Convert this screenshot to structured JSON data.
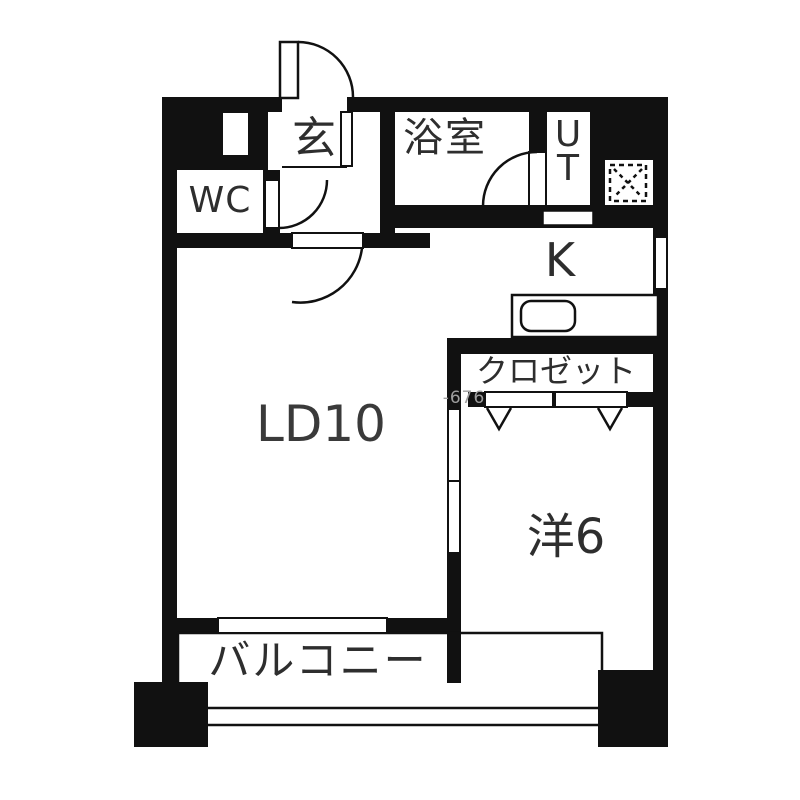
{
  "plan_title": "1LDK apartment floor plan",
  "rooms": {
    "entrance": {
      "label": "玄"
    },
    "wc": {
      "label": "WC"
    },
    "bathroom": {
      "label": "浴室"
    },
    "utility": {
      "line1": "U",
      "line2": "T"
    },
    "kitchen": {
      "label": "K"
    },
    "living_dining": {
      "label": "LD10"
    },
    "closet": {
      "label": "クロゼット"
    },
    "western_room": {
      "label": "洋6"
    },
    "balcony": {
      "label": "バルコニー"
    }
  },
  "watermark": {
    "text": "-676"
  },
  "fixtures": {
    "sink": "kitchen-sink",
    "pipe_space": "hatched-duct-square",
    "doors": [
      "entrance-swing-door",
      "wc-swing-door",
      "ld-swing-door",
      "bath-swing-door",
      "closet-folding-doors",
      "room-sliding-doors"
    ]
  },
  "colors": {
    "wall": "#111111",
    "background": "#ffffff",
    "text": "#2e2e2e",
    "watermark": "#9e9e9e"
  }
}
